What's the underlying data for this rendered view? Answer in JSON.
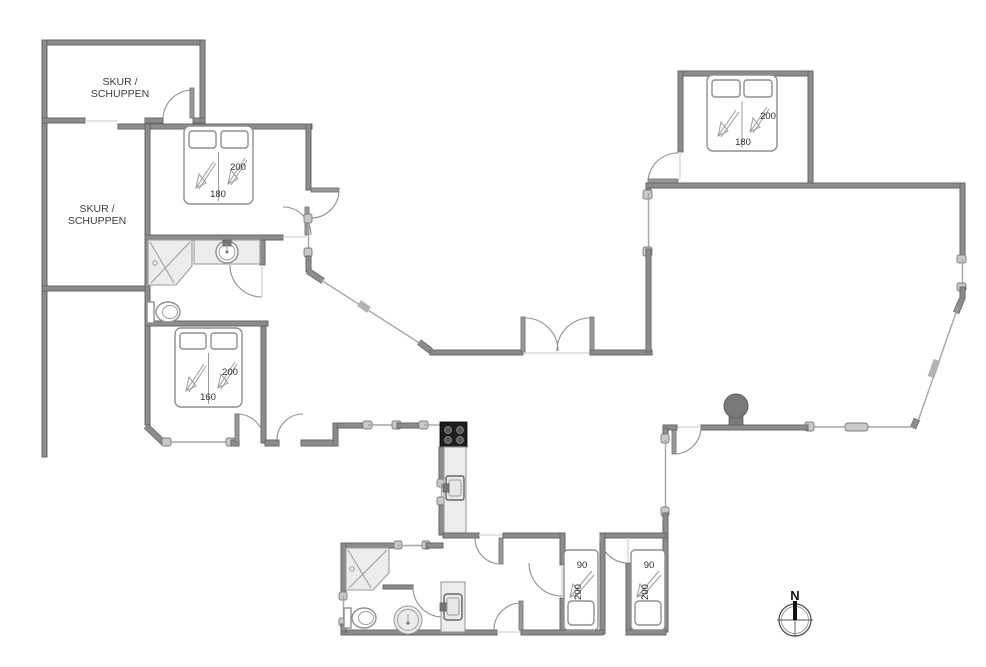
{
  "sheds": {
    "upper": {
      "line1": "SKUR /",
      "line2": "SCHUPPEN"
    },
    "lower": {
      "line1": "SKUR /",
      "line2": "SCHUPPEN"
    }
  },
  "beds": {
    "top_left": {
      "width": "180",
      "length": "200"
    },
    "top_right": {
      "width": "180",
      "length": "200"
    },
    "middle_left": {
      "width": "160",
      "length": "200"
    },
    "south_1": {
      "width": "90",
      "length": "200"
    },
    "south_2": {
      "width": "90",
      "length": "200"
    }
  },
  "compass": {
    "north": "N"
  },
  "colors": {
    "wall": "#8c8c8c",
    "wall_edge": "#676767",
    "fixture_light": "#ececec",
    "stove_black": "#1d1d1d",
    "wood_stove": "#7a7a7a",
    "glass": "#a6a6a6",
    "label_text": "#3c3c3c"
  }
}
